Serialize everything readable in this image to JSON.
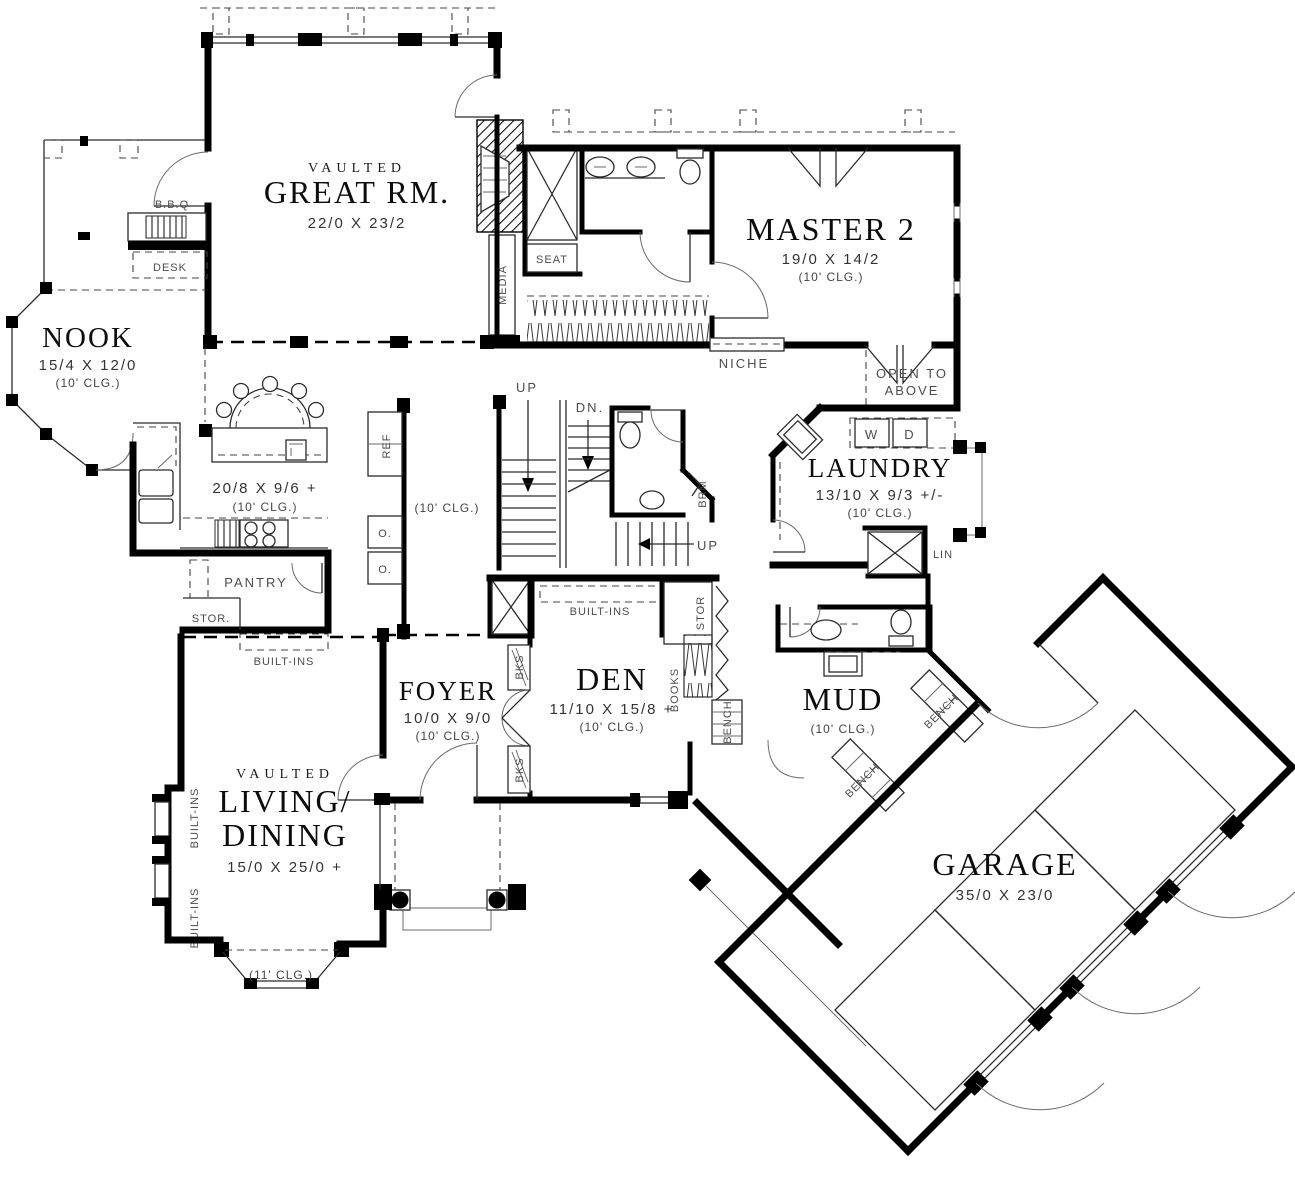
{
  "plan": {
    "rooms": {
      "great_rm": {
        "vaulted": "VAULTED",
        "name": "GREAT RM.",
        "dims": "22/0 X 23/2"
      },
      "nook": {
        "name": "NOOK",
        "dims": "15/4 X 12/0",
        "clg": "(10' CLG.)"
      },
      "master2": {
        "name": "MASTER 2",
        "dims": "19/0 X 14/2",
        "clg": "(10' CLG.)"
      },
      "kitchen": {
        "dims": "20/8 X 9/6 +",
        "clg": "(10' CLG.)"
      },
      "laundry": {
        "name": "LAUNDRY",
        "dims": "13/10 X 9/3 +/-",
        "clg": "(10' CLG.)"
      },
      "foyer": {
        "name": "FOYER",
        "dims": "10/0 X 9/0",
        "clg": "(10' CLG.)"
      },
      "den": {
        "name": "DEN",
        "dims": "11/10 X 15/8 +",
        "clg": "(10' CLG.)"
      },
      "mud": {
        "name": "MUD",
        "clg": "(10' CLG.)"
      },
      "living": {
        "vaulted": "VAULTED",
        "line1": "LIVING/",
        "line2": "DINING",
        "dims": "15/0 X 25/0 +",
        "bay_clg": "(11' CLG.)"
      },
      "garage": {
        "name": "GARAGE",
        "dims": "35/0 X 23/0"
      }
    },
    "labels": {
      "bbq": "B.B.Q",
      "desk": "DESK",
      "media": "MEDIA",
      "seat": "SEAT",
      "niche": "NICHE",
      "open_to": "OPEN TO",
      "above": "ABOVE",
      "up": "UP",
      "dn": "DN.",
      "brm": "BRM",
      "ref": "REF",
      "oven": "O.",
      "washer": "W",
      "dryer": "D",
      "lin": "LIN",
      "pantry": "PANTRY",
      "stor": "STOR.",
      "stor_short": "STOR",
      "built_ins": "BUILT-INS",
      "bks": "BKS",
      "books": "BOOKS",
      "bench": "BENCH",
      "hall_clg": "(10' CLG.)"
    }
  }
}
